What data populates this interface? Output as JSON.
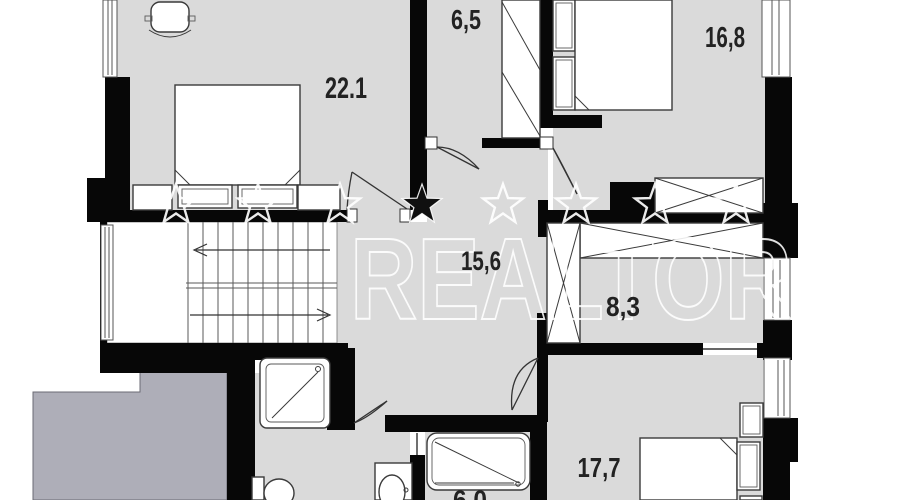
{
  "plan": {
    "type": "apartment-floor-plan",
    "rooms": [
      {
        "id": "bedroom-top-left",
        "area": "22.1"
      },
      {
        "id": "closet",
        "area": "6,5"
      },
      {
        "id": "bedroom-top-right",
        "area": "16,8"
      },
      {
        "id": "hall",
        "area": "15,6"
      },
      {
        "id": "wardrobe-room",
        "area": "8,3"
      },
      {
        "id": "bedroom-bottom",
        "area": "17,7"
      },
      {
        "id": "bathroom",
        "area": "6,0"
      }
    ],
    "fixtures": [
      "staircase",
      "double-bed",
      "double-bed",
      "single-bed",
      "chair",
      "shower-cabin",
      "toilet",
      "sink",
      "bathtub",
      "wardrobes",
      "windows"
    ]
  },
  "watermark": {
    "text": "REALTOR",
    "stars": [
      {
        "x": 176,
        "y": 205,
        "filled": false
      },
      {
        "x": 258,
        "y": 205,
        "filled": false
      },
      {
        "x": 340,
        "y": 205,
        "filled": false
      },
      {
        "x": 422,
        "y": 205,
        "filled": true
      },
      {
        "x": 503,
        "y": 205,
        "filled": false
      },
      {
        "x": 576,
        "y": 205,
        "filled": false
      },
      {
        "x": 655,
        "y": 205,
        "filled": false
      },
      {
        "x": 736,
        "y": 205,
        "filled": false
      }
    ],
    "star_outer_radius": 21,
    "star_inner_radius": 8.5
  },
  "colors": {
    "floor": "#dadada",
    "wall": "#070707",
    "void_block": "#aeaeb8",
    "background": "#ffffff",
    "label_text": "#222222",
    "watermark": "#ffffff"
  }
}
